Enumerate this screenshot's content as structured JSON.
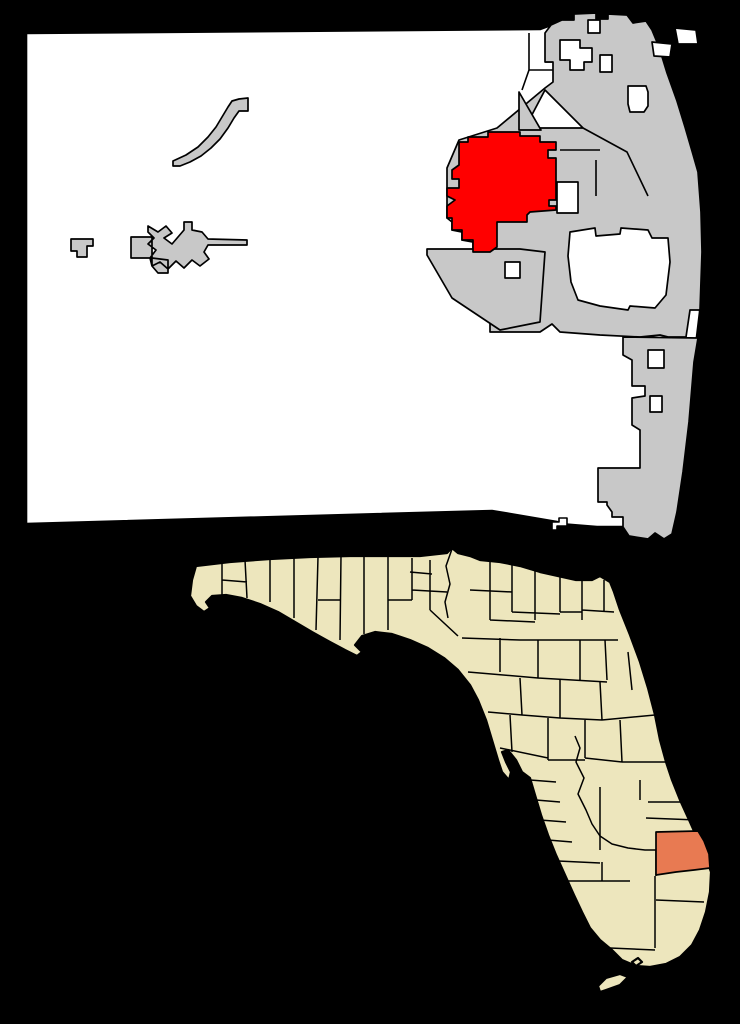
{
  "colors": {
    "background": "#000000",
    "county_fill": "#ffffff",
    "municipality_fill": "#c8c8c8",
    "highlight_red": "#ff0000",
    "state_fill": "#ede6bd",
    "highlight_salmon": "#e87a52",
    "border": "#000000"
  },
  "county_map": {
    "outline": "M26,33 L540,29 L551,25 L562,20 L574,20 L574,14 L596,13 L596,19 L608,19 L608,14 L627,15 L633,23 L646,21 L652,30 L659,47 L667,73 L677,101 L685,127 L692,151 L698,172 L701,212 L702,252 L700,312 L694,362 L689,422 L683,472 L677,512 L672,534 L664,539 L655,533 L648,539 L629,536 L623,527 L597,527 L560,524 L557,522 L492,511 L26,524 Z",
    "boundary_lines": "M529,33 L529,70 L588,70 M529,70 L522,90 M545,62 L553,62",
    "big_east": "M545,33 L545,62 L553,62 L553,82 L545,88 L497,128 L459,140 L447,168 L447,218 L452,222 L452,230 L462,232 L462,240 L473,242 L473,300 L481,312 L490,320 L490,332 L540,332 L552,324 L560,332 L600,335 L640,337 L660,335 L668,337 L686,337 L690,310 L700,310 L702,252 L701,212 L698,172 L692,151 L685,127 L677,101 L667,73 L659,47 L652,30 L646,21 L633,23 L627,15 L608,14 L608,19 L596,19 L596,13 L574,14 L574,20 L562,20 L551,25 Z",
    "wedge_sw": "M427,249 L520,249 L545,252 L540,322 L500,330 L452,298 L427,255 Z",
    "coastal_strip": "M623,337 L698,338 L694,362 L689,422 L683,472 L677,512 L672,534 L664,539 L655,533 L648,539 L629,536 L623,527 L623,517 L612,517 L612,512 L607,505 L607,502 L598,502 L598,468 L640,468 L640,430 L632,425 L632,398 L645,396 L645,386 L632,386 L632,360 L623,355 Z",
    "gray_triangle": "M519,92 L541,130 L519,130 Z",
    "gray_inner_lines": "M583,128 L627,152 L648,196 M596,160 L596,196 M560,150 L600,150",
    "white_patches": "M560,40 L580,40 L580,48 L592,48 L592,62 L584,62 L584,70 L570,70 L570,60 L560,60 Z M600,55 L612,55 L612,72 L600,72 Z M628,86 L646,86 L648,92 L648,106 L644,112 L630,112 L628,104 Z M588,20 L600,20 L600,33 L588,33 Z M675,28 L696,30 L698,44 L678,44 Z M652,42 L672,44 L670,57 L654,56 Z M545,90 L583,128 L525,128 Z M557,182 L578,182 L578,213 L557,213 Z M505,262 L520,262 L520,278 L505,278 Z M570,232 L595,228 L596,236 L620,234 L621,228 L648,230 L652,238 L668,238 L670,262 L666,295 L655,308 L630,306 L628,310 L600,306 L578,300 L571,282 L568,256 Z M648,350 L664,350 L664,368 L648,368 Z M650,396 L662,396 L662,412 L650,412 Z",
    "pahokee": "M173,161 L186,155 L198,147 L208,137 L216,127 L222,117 L228,107 L232,101 L239,99 L248,98 L248,111 L239,111 L234,118 L228,128 L220,139 L211,148 L201,156 L190,162 L180,166 L173,166 Z",
    "belle_glade": "M131,237 L152,237 L152,258 L131,258 Z M148,226 L158,232 L166,226 L172,233 L164,238 L172,244 L184,230 L184,222 L192,222 L192,230 L202,232 L208,239 L247,240 L247,245 L208,245 L204,252 L209,259 L200,266 L192,260 L184,268 L176,261 L168,269 L160,262 L152,266 L150,258 L156,250 L148,244 L154,238 L148,232 Z M152,258 L168,260 L168,273 L158,273 L152,266 Z",
    "south_bay": "M71,239 L93,239 L93,246 L87,246 L87,257 L77,257 L77,251 L71,251 Z",
    "red_community": "M459,142 L468,142 L468,137 L488,137 L488,132 L520,132 L520,136 L540,136 L540,142 L556,142 L556,150 L548,150 L548,158 L556,158 L556,200 L549,200 L549,206 L556,206 L556,210 L530,212 L527,215 L527,222 L497,222 L497,247 L490,252 L473,252 L473,240 L462,240 L462,230 L452,230 L452,218 L447,218 L447,206 L455,200 L447,196 L447,188 L459,188 L459,179 L452,179 L452,170 L459,165 Z",
    "black_wedge": "M492,511 L557,521 L557,531 L540,531 L492,517 Z",
    "white_notch": "M552,522 L559,522 L559,518 L567,518 L567,526 L557,526 L557,530 L552,530 Z"
  },
  "state_map": {
    "outline": "M196,566 L230,562 L270,559 L310,557 L350,556 L390,556 L420,556 L447,553 L452,548 L458,553 L470,556 L480,560 L500,562 L520,566 L540,572 L558,576 L576,580 L592,580 L600,576 L610,582 L614,592 L620,610 L630,635 L640,662 L648,688 L655,715 L660,740 L666,762 L672,780 L680,800 L690,822 L698,840 L706,858 L711,872 L710,892 L706,912 L700,930 L692,945 L680,957 L666,964 L650,967 L636,966 L622,960 L612,950 L600,940 L590,928 L582,912 L574,895 L565,875 L556,855 L548,835 L541,815 L535,795 L530,778 L522,772 L516,760 L508,750 L502,752 L506,762 L511,772 L509,780 L502,772 L498,760 L492,740 L486,720 L478,700 L470,685 L458,670 L444,658 L428,648 L410,640 L392,634 L375,632 L362,636 L355,645 L362,652 L357,656 L345,650 L330,642 L312,632 L295,622 L278,612 L260,604 L242,598 L226,595 L212,596 L206,602 L210,608 L204,612 L196,606 L190,596 L192,580 Z",
    "keys": "M598,986 L606,978 L620,974 L628,977 L620,985 L606,990 L600,992 Z M632,962 L638,958 L642,962 L636,966 Z",
    "lines_panhandle": "M222,563 L222,598 M245,560 L247,598 M270,558 L270,602 M294,557 L294,618 M318,557 L316,630 M341,556 L340,640 M364,556 L364,634 M388,556 L388,630 M222,580 L247,582 M318,600 L341,600 M410,572 L432,574 M412,558 L412,600 M412,590 L447,592 M430,560 L430,610 M452,549 L446,566 L450,584 L445,602 L448,618 M388,600 L412,600 M430,610 L458,636",
    "lines_north": "M490,562 L490,620 M512,564 L512,612 M535,570 L535,620 M560,577 L560,612 M582,580 L582,620 M604,580 L604,612 M470,590 L512,592 M490,620 L535,622 M512,612 L560,614 M560,612 L582,612 M582,610 L614,612 M462,638 L520,640 M520,640 L580,640 M580,640 L618,640 M500,638 L500,672 M538,640 L538,678 M580,640 L580,680 M605,640 L607,680 M628,652 L632,690 M468,672 L538,678 M538,678 L607,682",
    "lines_central": "M520,678 L522,715 M560,680 L560,718 M600,682 L602,720 M488,712 L522,715 M522,715 L560,718 M560,718 L602,720 M602,720 L655,715 M510,715 L512,752 M548,718 L548,760 M585,720 L585,758 M620,720 L622,762 M500,748 L548,758 M548,760 L585,760 M585,758 L622,762 M622,762 L666,762 M640,780 L640,800 M648,802 L690,802 M646,818 L697,820 M530,780 L556,782 M536,800 L560,802 M540,820 L566,822 M548,840 L572,842 M600,787 L600,850",
    "kissimmee_river": "M575,736 L580,748 L576,762 L584,778 L578,794 L586,810 L592,824 L600,836 L612,844 L628,848 L645,850 L656,850",
    "lines_south": "M558,861 L600,863 M602,862 L602,881 M560,881 L630,881 M655,876 L655,948 M656,900 L704,902 M610,948 L655,950 M656,850 L656,876",
    "salmon_county": "M656,832 L698,831 L704,841 L709,854 L710,868 L694,870 L676,872 L656,875 Z"
  }
}
